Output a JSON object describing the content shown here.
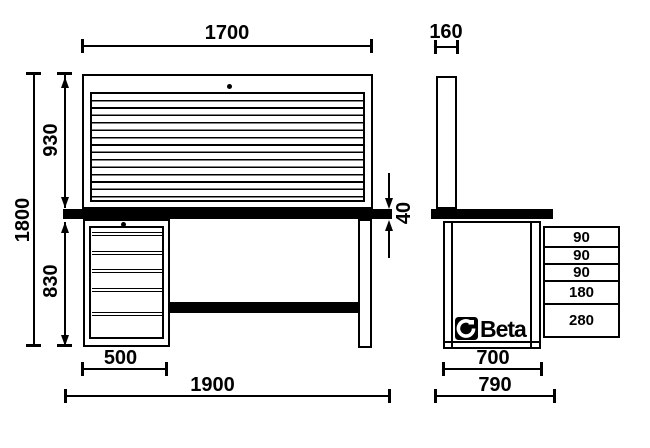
{
  "colors": {
    "ink": "#000000",
    "paper": "#ffffff"
  },
  "front_view": {
    "dim_top_width": "1700",
    "dim_panel_height": "930",
    "dim_total_height": "1800",
    "dim_lower_height": "830",
    "dim_worktop_thickness": "40",
    "dim_cabinet_width": "500",
    "dim_total_width": "1900"
  },
  "side_view": {
    "dim_panel_depth": "160",
    "dim_body_depth": "700",
    "dim_total_depth": "790",
    "drawer_heights": [
      "90",
      "90",
      "90",
      "180",
      "280"
    ],
    "brand": {
      "name": "Beta",
      "icon": "beta-helmet-icon"
    }
  }
}
